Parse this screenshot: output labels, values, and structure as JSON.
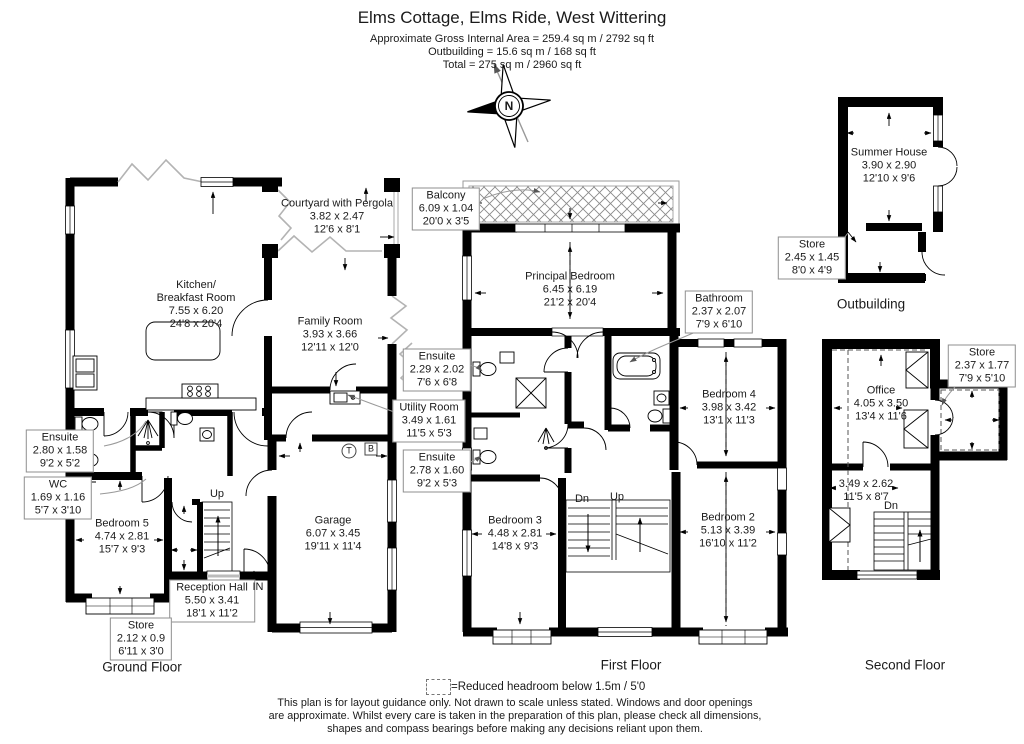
{
  "header": {
    "title": "Elms Cottage, Elms Ride, West Wittering",
    "area_line1": "Approximate Gross Internal Area = 259.4 sq m / 2792 sq ft",
    "area_line2": "Outbuilding = 15.6 sq m / 168 sq ft",
    "area_line3": "Total = 275 sq m / 2960 sq ft"
  },
  "compass": {
    "north_label": "N"
  },
  "floor_labels": {
    "ground": "Ground Floor",
    "first": "First Floor",
    "second": "Second Floor",
    "outbuilding": "Outbuilding"
  },
  "rooms": {
    "kitchen": {
      "line1": "Kitchen/",
      "line2": "Breakfast Room",
      "metric": "7.55 x 6.20",
      "imperial": "24'8 x 20'4"
    },
    "courtyard": {
      "line1": "Courtyard with Pergola",
      "metric": "3.82 x 2.47",
      "imperial": "12'6 x 8'1"
    },
    "family": {
      "line1": "Family Room",
      "metric": "3.93 x 3.66",
      "imperial": "12'11 x 12'0"
    },
    "gf_ensuite": {
      "line1": "Ensuite",
      "metric": "2.80 x 1.58",
      "imperial": "9'2 x 5'2"
    },
    "wc": {
      "line1": "WC",
      "metric": "1.69 x 1.16",
      "imperial": "5'7 x 3'10"
    },
    "bedroom5": {
      "line1": "Bedroom 5",
      "metric": "4.74 x 2.81",
      "imperial": "15'7 x 9'3"
    },
    "utility": {
      "line1": "Utility Room",
      "metric": "3.49 x 1.61",
      "imperial": "11'5 x 5'3"
    },
    "garage": {
      "line1": "Garage",
      "metric": "6.07 x 3.45",
      "imperial": "19'11 x 11'4"
    },
    "reception": {
      "line1": "Reception Hall",
      "metric": "5.50 x 3.41",
      "imperial": "18'1 x 11'2"
    },
    "gf_store": {
      "line1": "Store",
      "metric": "2.12 x 0.9",
      "imperial": "6'11 x 3'0"
    },
    "balcony": {
      "line1": "Balcony",
      "metric": "6.09 x 1.04",
      "imperial": "20'0 x 3'5"
    },
    "principal": {
      "line1": "Principal Bedroom",
      "metric": "6.45 x 6.19",
      "imperial": "21'2 x 20'4"
    },
    "ff_ensuite1": {
      "line1": "Ensuite",
      "metric": "2.29 x 2.02",
      "imperial": "7'6 x 6'8"
    },
    "bathroom": {
      "line1": "Bathroom",
      "metric": "2.37 x 2.07",
      "imperial": "7'9 x 6'10"
    },
    "bedroom4": {
      "line1": "Bedroom 4",
      "metric": "3.98 x 3.42",
      "imperial": "13'1 x 11'3"
    },
    "ff_ensuite2": {
      "line1": "Ensuite",
      "metric": "2.78 x 1.60",
      "imperial": "9'2 x 5'3"
    },
    "bedroom3": {
      "line1": "Bedroom 3",
      "metric": "4.48 x 2.81",
      "imperial": "14'8 x 9'3"
    },
    "bedroom2": {
      "line1": "Bedroom 2",
      "metric": "5.13 x 3.39",
      "imperial": "16'10 x 11'2"
    },
    "summer": {
      "line1": "Summer House",
      "metric": "3.90 x 2.90",
      "imperial": "12'10 x 9'6"
    },
    "ob_store": {
      "line1": "Store",
      "metric": "2.45 x 1.45",
      "imperial": "8'0 x 4'9"
    },
    "office": {
      "line1": "Office",
      "metric": "4.05 x 3.50",
      "imperial": "13'4 x 11'6"
    },
    "sf_store": {
      "line1": "Store",
      "metric": "2.37 x 1.77",
      "imperial": "7'9 x 5'10"
    },
    "sf_landing": {
      "metric": "3.49 x 2.62",
      "imperial": "11'5 x 8'7"
    }
  },
  "annotations": {
    "up_ground": "Up",
    "in_label": "IN",
    "dn_first": "Dn",
    "up_first": "Up",
    "dn_second": "Dn",
    "tank_symbol": "T",
    "boiler_symbol": "B"
  },
  "footer": {
    "legend": "=Reduced headroom below 1.5m / 5'0",
    "disclaimer1": "This plan is for layout guidance only. Not drawn to scale unless stated. Windows and door openings",
    "disclaimer2": "are approximate. Whilst every care is taken in the preparation of this plan, please check all dimensions,",
    "disclaimer3": "shapes and compass bearings before making any decisions reliant upon them."
  },
  "colors": {
    "wall": "#000000",
    "background": "#ffffff",
    "label_border": "#8f8f8f",
    "leader": "#999999"
  }
}
